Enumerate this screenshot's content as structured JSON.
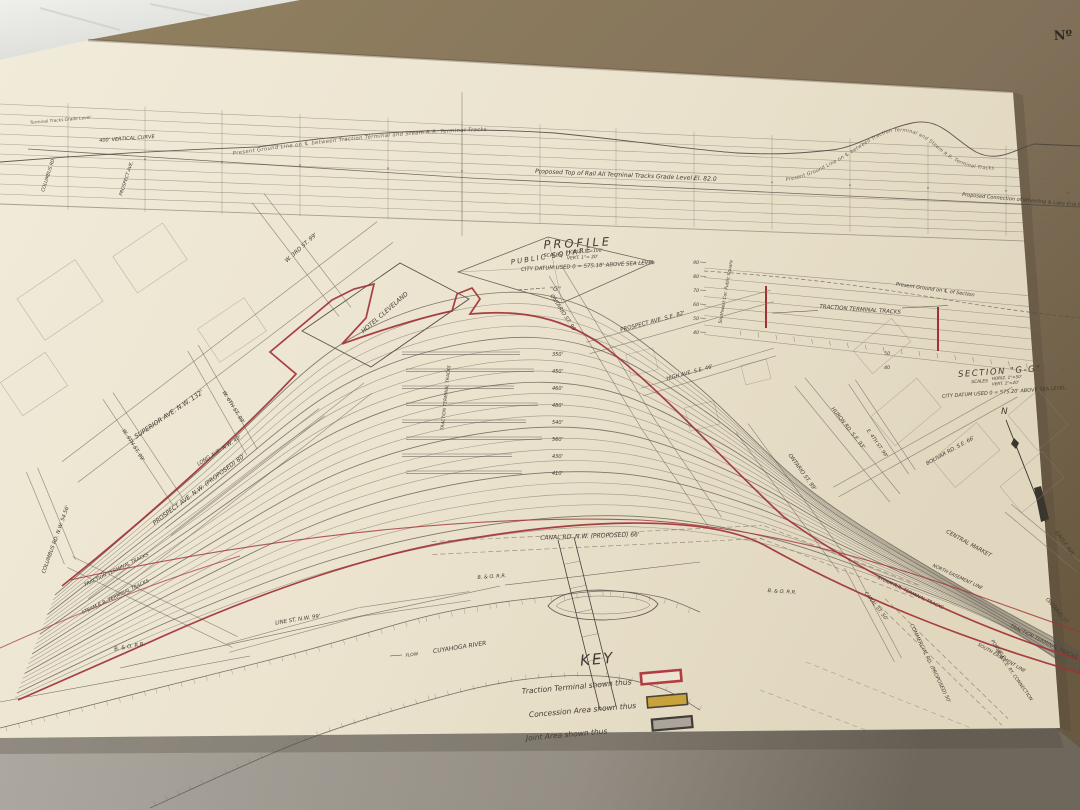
{
  "photo": {
    "stamp": "Nº"
  },
  "colors": {
    "red": "#a23136",
    "red_bright": "#b13c42",
    "yellow": "#c8a23a",
    "gray_swatch": "#aba49b",
    "ink": "#4e4a42",
    "paper": "#ece4d1",
    "board": "#82715a"
  },
  "profile": {
    "title": "PROFILE",
    "scales_word": "SCALES",
    "scale_horiz": "HORIZ. 1\"=100'",
    "scale_vert": "VERT. 1\"= 20'",
    "datum": "CITY DATUM USED  0 = 575.18' ABOVE SEA LEVEL",
    "vertical_curve": "400' VERTICAL CURVE",
    "ground_left": "Present Ground Line on ℄ between Traction Terminal and Steam R.R. Terminal Tracks",
    "top_of_rail": "Proposed Top of Rail  All Terminal Tracks   Grade Level    El. 82.0",
    "ground_right": "Present Ground Line on ℄ between Traction Terminal and Steam R.R. Terminal Tracks",
    "wle_grade": "Proposed Connection of Wheeling & Lake Erie Ry. Grade",
    "grade_note": "Terminal Tracks Grade Level",
    "station_columbus": "COLUMBUS RD.",
    "station_prospect": "PROSPECT AVE."
  },
  "section": {
    "title": "SECTION \"G-G\"",
    "scales_word": "SCALES",
    "scale_horiz": "HORIZ. 1\"=50'",
    "scale_vert": "VERT. 1\"=20'",
    "datum": "CITY DATUM USED  0 = 575.20' ABOVE SEA LEVEL",
    "tracks_label": "TRACTION  TERMINAL  TRACKS",
    "ground_label": "Present Ground on ℄ of Section",
    "corner_label": "Southwest Cor. Public Square",
    "elevations": [
      "90",
      "80",
      "70",
      "60",
      "50",
      "40"
    ],
    "elevations2": [
      "50",
      "40"
    ]
  },
  "compass": {
    "north": "N"
  },
  "plan": {
    "public_square": "PUBLIC  SQUARE",
    "hotel_cleveland": "HOTEL  CLEVELAND",
    "w3rd": "W. 3RD  ST.  99'",
    "w6th": "W. 6TH  ST.  99'",
    "w9th": "W. 9TH  ST.  99'",
    "superior": "SUPERIOR   AVE.   N.W.   132'",
    "long_ave": "LONG  AVE.  N.W.  40'",
    "prospect_nw": "PROSPECT   AVE.   N.W.   (PROPOSED)   80'",
    "columbus": "COLUMBUS  RD.  N.W.  54.56'",
    "traction_left": "TRACTION  TERMINAL  TRACKS",
    "steam_left": "STEAM  R.R.  TERMINAL  TRACKS",
    "bo_left": "B. & O.  R.R.",
    "bo_mid": "B. & O.  R.R.",
    "bo_right": "B. & O.  R.R.",
    "line_st": "LINE   ST.   N.W.   99'",
    "cuyahoga": "CUYAHOGA   RIVER",
    "flow": "FLOW",
    "canal_rd": "CANAL   RD.   N.W.   (PROPOSED)        66'",
    "ontario_upper": "ONTARIO  ST.  99'",
    "prospect_se": "PROSPECT  AVE.  S.E.  82'",
    "high_ave": "HIGH  AVE.  S.E.  46'",
    "huron": "HURON  RD.  S.E.  93'",
    "e4th": "E. 4TH  ST.  99'",
    "ontario_mid": "ONTARIO  ST.  99'",
    "bolivar": "BOLIVAR  RD.  S.E.  66'",
    "central_market": "CENTRAL  MARKET",
    "eagle": "EAGLE  AVE.",
    "canal_st": "CANAL  ST.  50'",
    "commercial": "COMMERCIAL  RD.  (PROPOSED)  50'",
    "north_easement": "NORTH  EASEMENT  LINE",
    "south_easement": "SOUTH  EASEMENT  LINE",
    "possible": "POSSIBLE",
    "wle_connection": "W. & L.E.  RY.  CONNECTION",
    "traction_right": "TRACTION  TERMINAL  TRACKS",
    "steam_right": "STEAM  R.R.  TERMINAL  TRACKS",
    "ontario_right": "ONTARIO  ST.",
    "g_marker": "\"G\"",
    "yard_label": "TRACTION  TERMINAL  TRACKS",
    "platform_lengths": [
      "350'",
      "450'",
      "460'",
      "480'",
      "540'",
      "560'",
      "430'",
      "410'"
    ]
  },
  "key": {
    "title": "KEY",
    "entries": [
      {
        "label": "Traction  Terminal  shown  thus"
      },
      {
        "label": "Concession  Area  shown  thus"
      },
      {
        "label": "Joint  Area  shown  thus"
      }
    ]
  }
}
